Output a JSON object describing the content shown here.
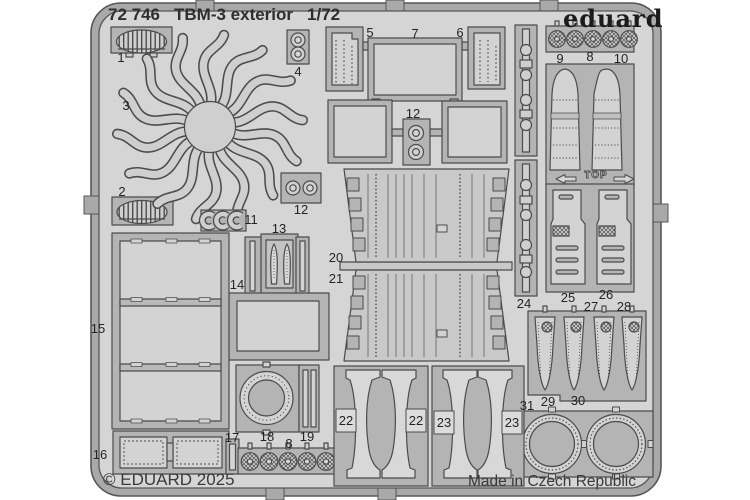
{
  "header": {
    "catalog_number": "72 746",
    "title": "TBM-3 exterior",
    "scale": "1/72"
  },
  "brand": {
    "logo_text": "eduard"
  },
  "footer": {
    "copyright": "© EDUARD 2025",
    "origin": "Made in Czech Republic"
  },
  "sheet": {
    "top_marker": "TOP"
  },
  "part_labels": {
    "p1": "1",
    "p2": "2",
    "p3": "3",
    "p4": "4",
    "p5": "5",
    "p6": "6",
    "p7": "7",
    "p8_top": "8",
    "p8_bottom": "8",
    "p9": "9",
    "p10": "10",
    "p11": "11",
    "p12_left": "12",
    "p12_mid": "12",
    "p13": "13",
    "p14": "14",
    "p15": "15",
    "p16": "16",
    "p17": "17",
    "p18": "18",
    "p19": "19",
    "p20": "20",
    "p21": "21",
    "p22_left": "22",
    "p22_right": "22",
    "p23_left": "23",
    "p23_right": "23",
    "p24": "24",
    "p25": "25",
    "p26": "26",
    "p27": "27",
    "p28": "28",
    "p29": "29",
    "p30": "30",
    "p31": "31"
  },
  "colors": {
    "background": "#ffffff",
    "sheet": "#d5d5d5",
    "frame_band": "#a9a9a9",
    "panel": "#b4b4b4",
    "part": "#cfcfcf",
    "part_light": "#d3d3d3",
    "outline": "#4c4c4c",
    "text": "#2b2b2b"
  }
}
